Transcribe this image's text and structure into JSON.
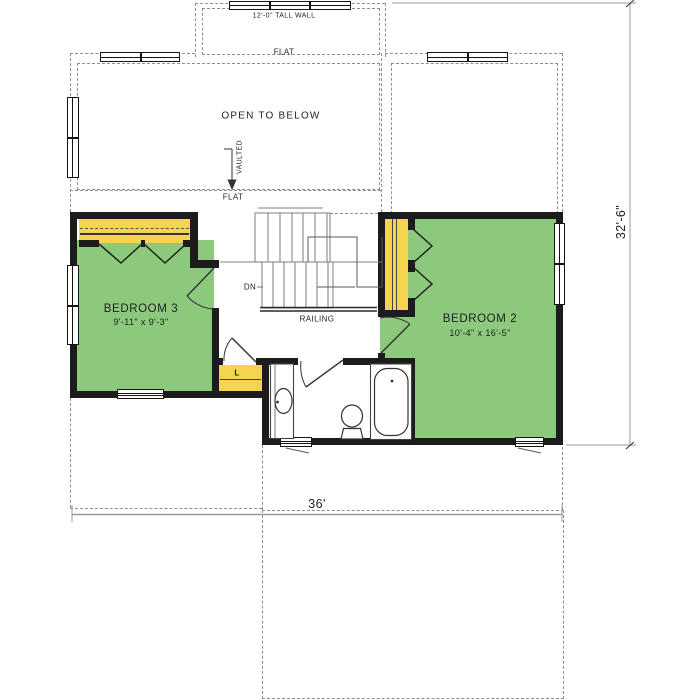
{
  "plan": {
    "rooms": {
      "bedroom3": {
        "name": "BEDROOM 3",
        "size": "9'-11\" x 9'-3\""
      },
      "bedroom2": {
        "name": "BEDROOM 2",
        "size": "10'-4\" x 16'-5\""
      }
    },
    "labels": {
      "tall_wall": "12'-0\" TALL WALL",
      "flat": "FLAT",
      "open_to_below": "OPEN TO BELOW",
      "vaulted": "VAULTED",
      "down": "DN",
      "railing": "RAILING",
      "linen_closet": "L"
    },
    "dimensions": {
      "overall_width": "36'",
      "overall_depth": "32'-6\""
    },
    "colors": {
      "room_fill_green": "#8CC97C",
      "closet_fill_yellow": "#F5D54F",
      "wall_black": "#1C1C1C"
    }
  }
}
